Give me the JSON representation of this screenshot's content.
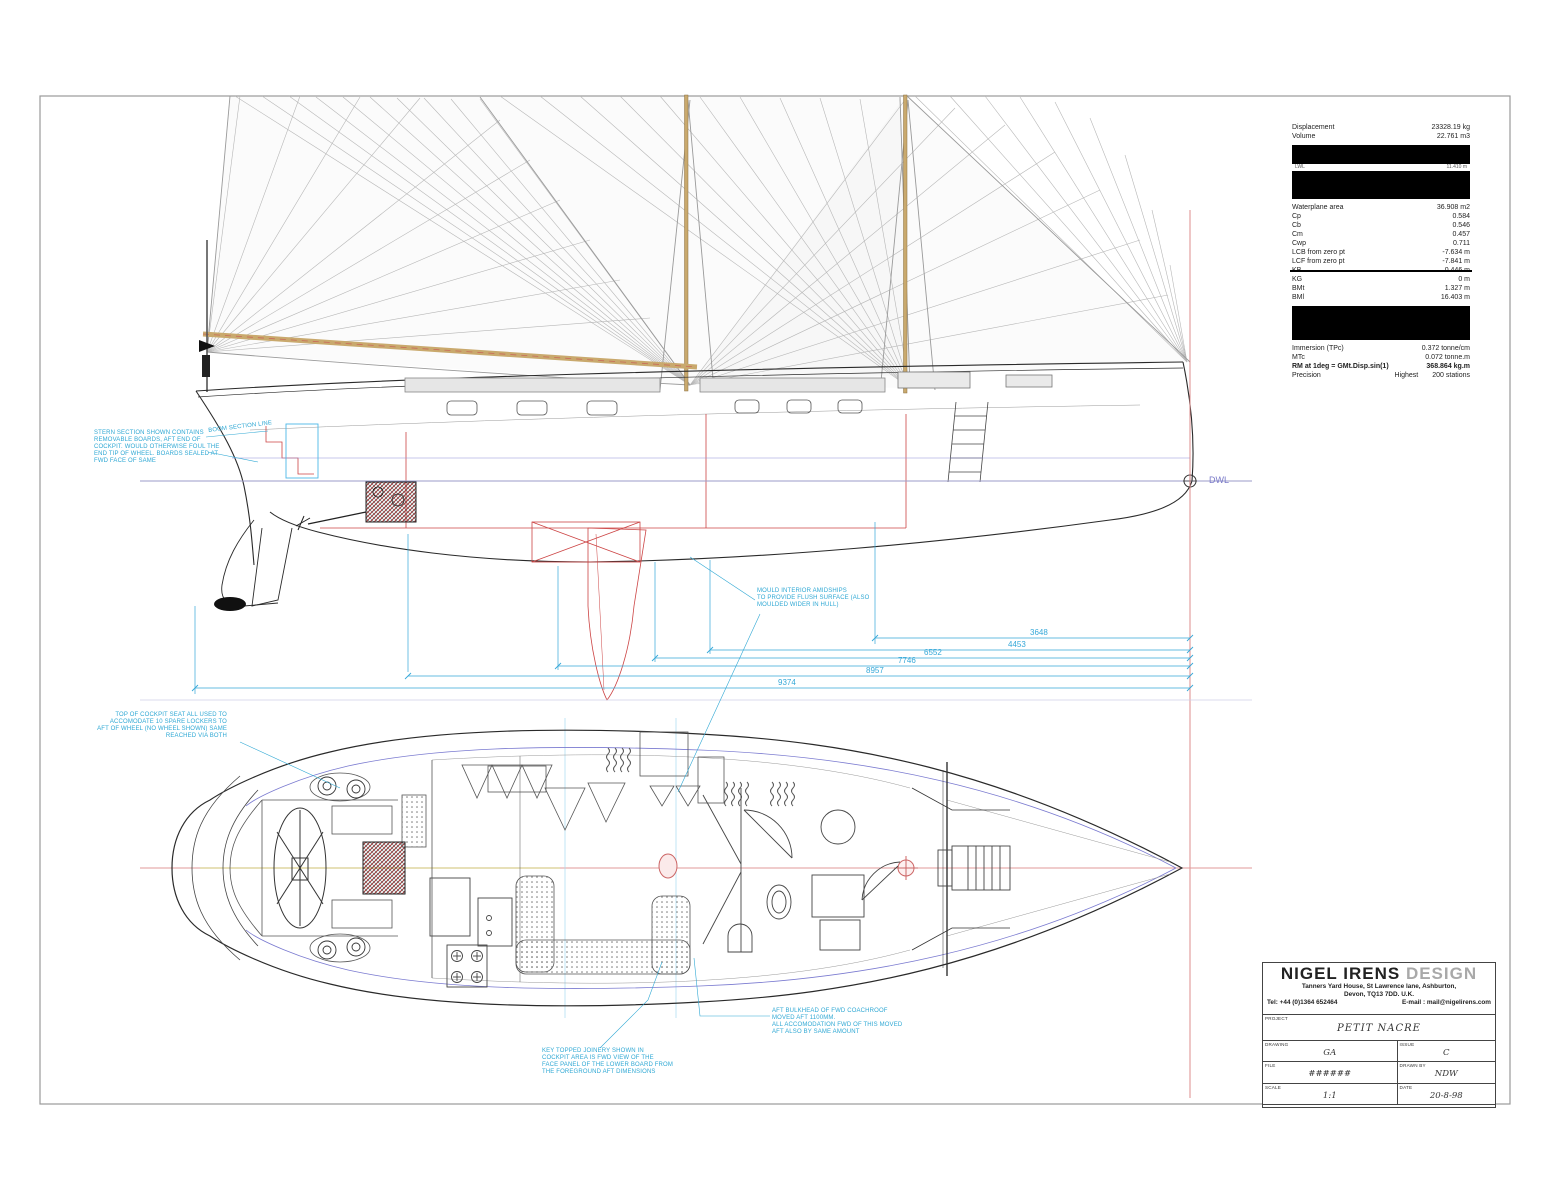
{
  "hydrostatics": {
    "rows_top": [
      {
        "label": "Displacement",
        "value": "23328.19 kg"
      },
      {
        "label": "Volume",
        "value": "22.761 m3"
      }
    ],
    "masked_row": {
      "label": "LWL",
      "value": "11.410 m"
    },
    "rows_mid": [
      {
        "label": "Waterplane area",
        "value": "36.908 m2"
      },
      {
        "label": "Cp",
        "value": "0.584"
      },
      {
        "label": "Cb",
        "value": "0.546"
      },
      {
        "label": "Cm",
        "value": "0.457"
      },
      {
        "label": "Cwp",
        "value": "0.711"
      },
      {
        "label": "LCB from zero pt",
        "value": "-7.634 m"
      },
      {
        "label": "LCF from zero pt",
        "value": "-7.841 m"
      }
    ],
    "struck_row": {
      "label": "KB",
      "value": "0.446 m"
    },
    "rows_lower": [
      {
        "label": "KG",
        "value": "0 m"
      },
      {
        "label": "BMt",
        "value": "1.327 m"
      },
      {
        "label": "BMl",
        "value": "16.403 m"
      }
    ],
    "rows_bottom": [
      {
        "label": "Immersion (TPc)",
        "value": "0.372 tonne/cm"
      },
      {
        "label": "MTc",
        "value": "0.072 tonne.m"
      }
    ],
    "rm_row": {
      "label": "RM at 1deg = GMt.Disp.sin(1)",
      "value": "368.864 kg.m"
    },
    "precision_row": {
      "label": "Precision",
      "value1": "Highest",
      "value2": "200 stations"
    }
  },
  "dimensions": {
    "values": [
      "3648",
      "4453",
      "6552",
      "7746",
      "8957",
      "9374"
    ]
  },
  "labels": {
    "dwl": "DWL"
  },
  "annotations": {
    "stern_note": {
      "lines": [
        "STERN SECTION SHOWN CONTAINS",
        "REMOVABLE BOARDS, AFT END OF",
        "COCKPIT. WOULD OTHERWISE FOUL THE",
        "END TIP OF WHEEL. BOARDS SEALED AT",
        "FWD FACE OF SAME"
      ]
    },
    "boom_label": "BOOM SECTION LINE",
    "mid_note": {
      "lines": [
        "MOULD INTERIOR AMIDSHIPS",
        "TO PROVIDE FLUSH SURFACE (ALSO",
        "MOULDED WIDER IN HULL)"
      ]
    },
    "plan_note": {
      "lines": [
        "TOP OF COCKPIT SEAT ALL USED TO",
        "ACCOMODATE 10 SPARE LOCKERS TO",
        "AFT OF WHEEL (NO WHEEL SHOWN) SAME",
        "REACHED VIA BOTH"
      ]
    },
    "bulkhead_note": {
      "lines": [
        "AFT BULKHEAD OF FWD COACHROOF",
        "MOVED AFT 1100MM.",
        "ALL ACCOMODATION FWD OF THIS MOVED",
        "AFT ALSO BY SAME AMOUNT"
      ]
    },
    "joinery_note": {
      "lines": [
        "KEY TOPPED JOINERY SHOWN IN",
        "COCKPIT AREA IS FWD VIEW OF THE",
        "FACE PANEL OF THE LOWER BOARD FROM",
        "THE FOREGROUND AFT DIMENSIONS"
      ]
    }
  },
  "title_block": {
    "company_primary": "NIGEL IRENS",
    "company_secondary": "DESIGN",
    "address1": "Tanners Yard House, St Lawrence lane, Ashburton,",
    "address2": "Devon, TQ13 7DD.   U.K.",
    "tel": "Tel: +44 (0)1364 652464",
    "email": "E-mail : mail@nigelirens.com",
    "fields": {
      "project_label": "PROJECT",
      "project": "PETIT NACRE",
      "drawing_label": "DRAWING",
      "drawing": "GA",
      "issue_label": "ISSUE",
      "issue": "C",
      "file_label": "FILE",
      "file": "######",
      "drawn_label": "DRAWN BY",
      "drawn": "NDW",
      "scale_label": "SCALE",
      "scale": "1:1",
      "date_label": "DATE",
      "date": "20-8-98"
    }
  },
  "colors": {
    "annotation_cyan": "#2fa8d4",
    "detail_red": "#cc4444",
    "waterline_blue": "#8080c8",
    "spar_tan": "#c9a96d"
  }
}
